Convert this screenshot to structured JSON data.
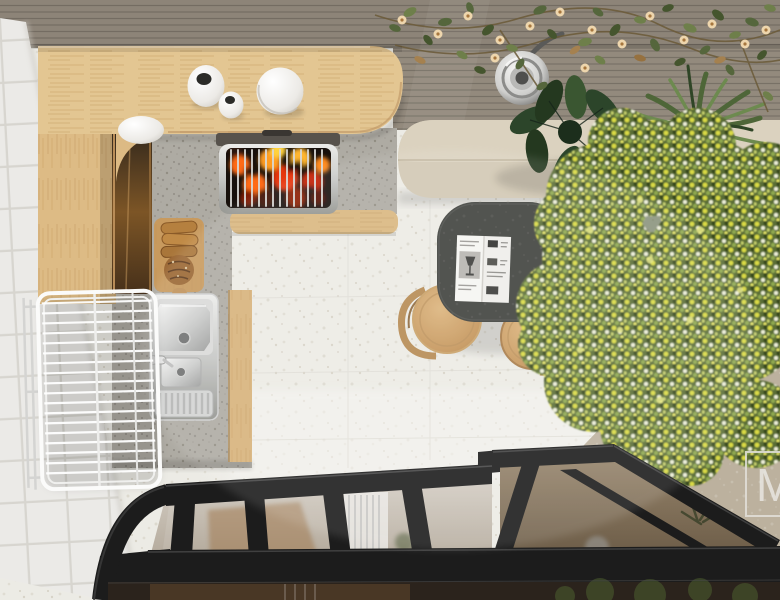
{
  "watermark": {
    "letter": "M"
  },
  "palette": {
    "frame_black": "#1c1c1c",
    "counter_wood": "#e3c692",
    "bench_stone": "#d2c8b3",
    "table_top": "#3e403c",
    "fire_accent": "#ff6a14",
    "tile_white": "#f3f2ef",
    "floor_terrazzo": "#ecebe5",
    "kitchen_stone": "#b6b2aa",
    "stainless": "#cfd0cf",
    "stool_wood": "#c9a066",
    "terrace_stone": "#bcb19e",
    "slat_wall": "#8d8478",
    "foliage_green": "#5a6d36",
    "foliage_yellow": "#d9da44",
    "monstera_green": "#2c452a",
    "vine_flower": "#eed6ad",
    "glass_tint": "#8f7f68",
    "watermark_color": "#e9e7e2"
  },
  "objects": [
    "wood-slat-wall",
    "flowering-vine",
    "pendant-lamp",
    "wall-lamp",
    "concrete-bench",
    "monstera-plant",
    "yucca-plant",
    "flowering-tree-canopy",
    "white-tile-wall",
    "wood-counter",
    "ceramic-vases",
    "serving-bowl",
    "charcoal-grill",
    "cutting-board-with-bread",
    "stainless-sink",
    "wire-drying-rack",
    "dining-table",
    "open-magazine",
    "bentwood-stools",
    "terrazzo-floor",
    "terrace-stone-floor",
    "black-glass-roof-frame",
    "watermark"
  ]
}
